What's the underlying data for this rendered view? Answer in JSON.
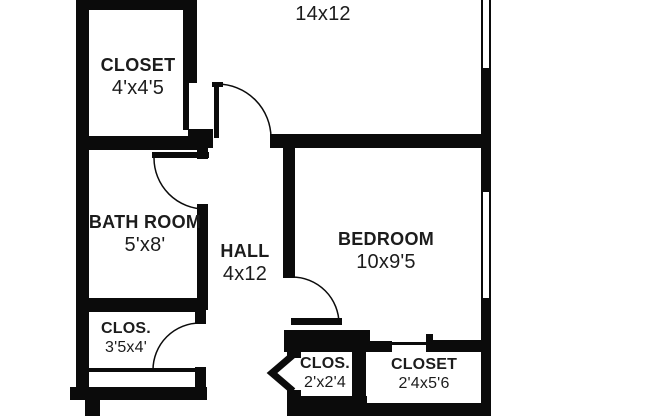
{
  "colors": {
    "background": "#ffffff",
    "wall": "#0b0b0b",
    "text": "#1c1c1c"
  },
  "rooms": [
    {
      "id": "room-top",
      "name": "",
      "dims": "14x12"
    },
    {
      "id": "closet-top-left",
      "name": "CLOSET",
      "dims": "4'x4'5"
    },
    {
      "id": "bathroom",
      "name": "BATH ROOM",
      "dims": "5'x8'"
    },
    {
      "id": "hall",
      "name": "HALL",
      "dims": "4x12"
    },
    {
      "id": "bedroom",
      "name": "BEDROOM",
      "dims": "10x9'5"
    },
    {
      "id": "closet-bottom-left",
      "name": "CLOS.",
      "dims": "3'5x4'"
    },
    {
      "id": "closet-bottom-center",
      "name": "CLOS.",
      "dims": "2'x2'4"
    },
    {
      "id": "closet-bottom-right",
      "name": "CLOSET",
      "dims": "2'4x5'6"
    }
  ]
}
